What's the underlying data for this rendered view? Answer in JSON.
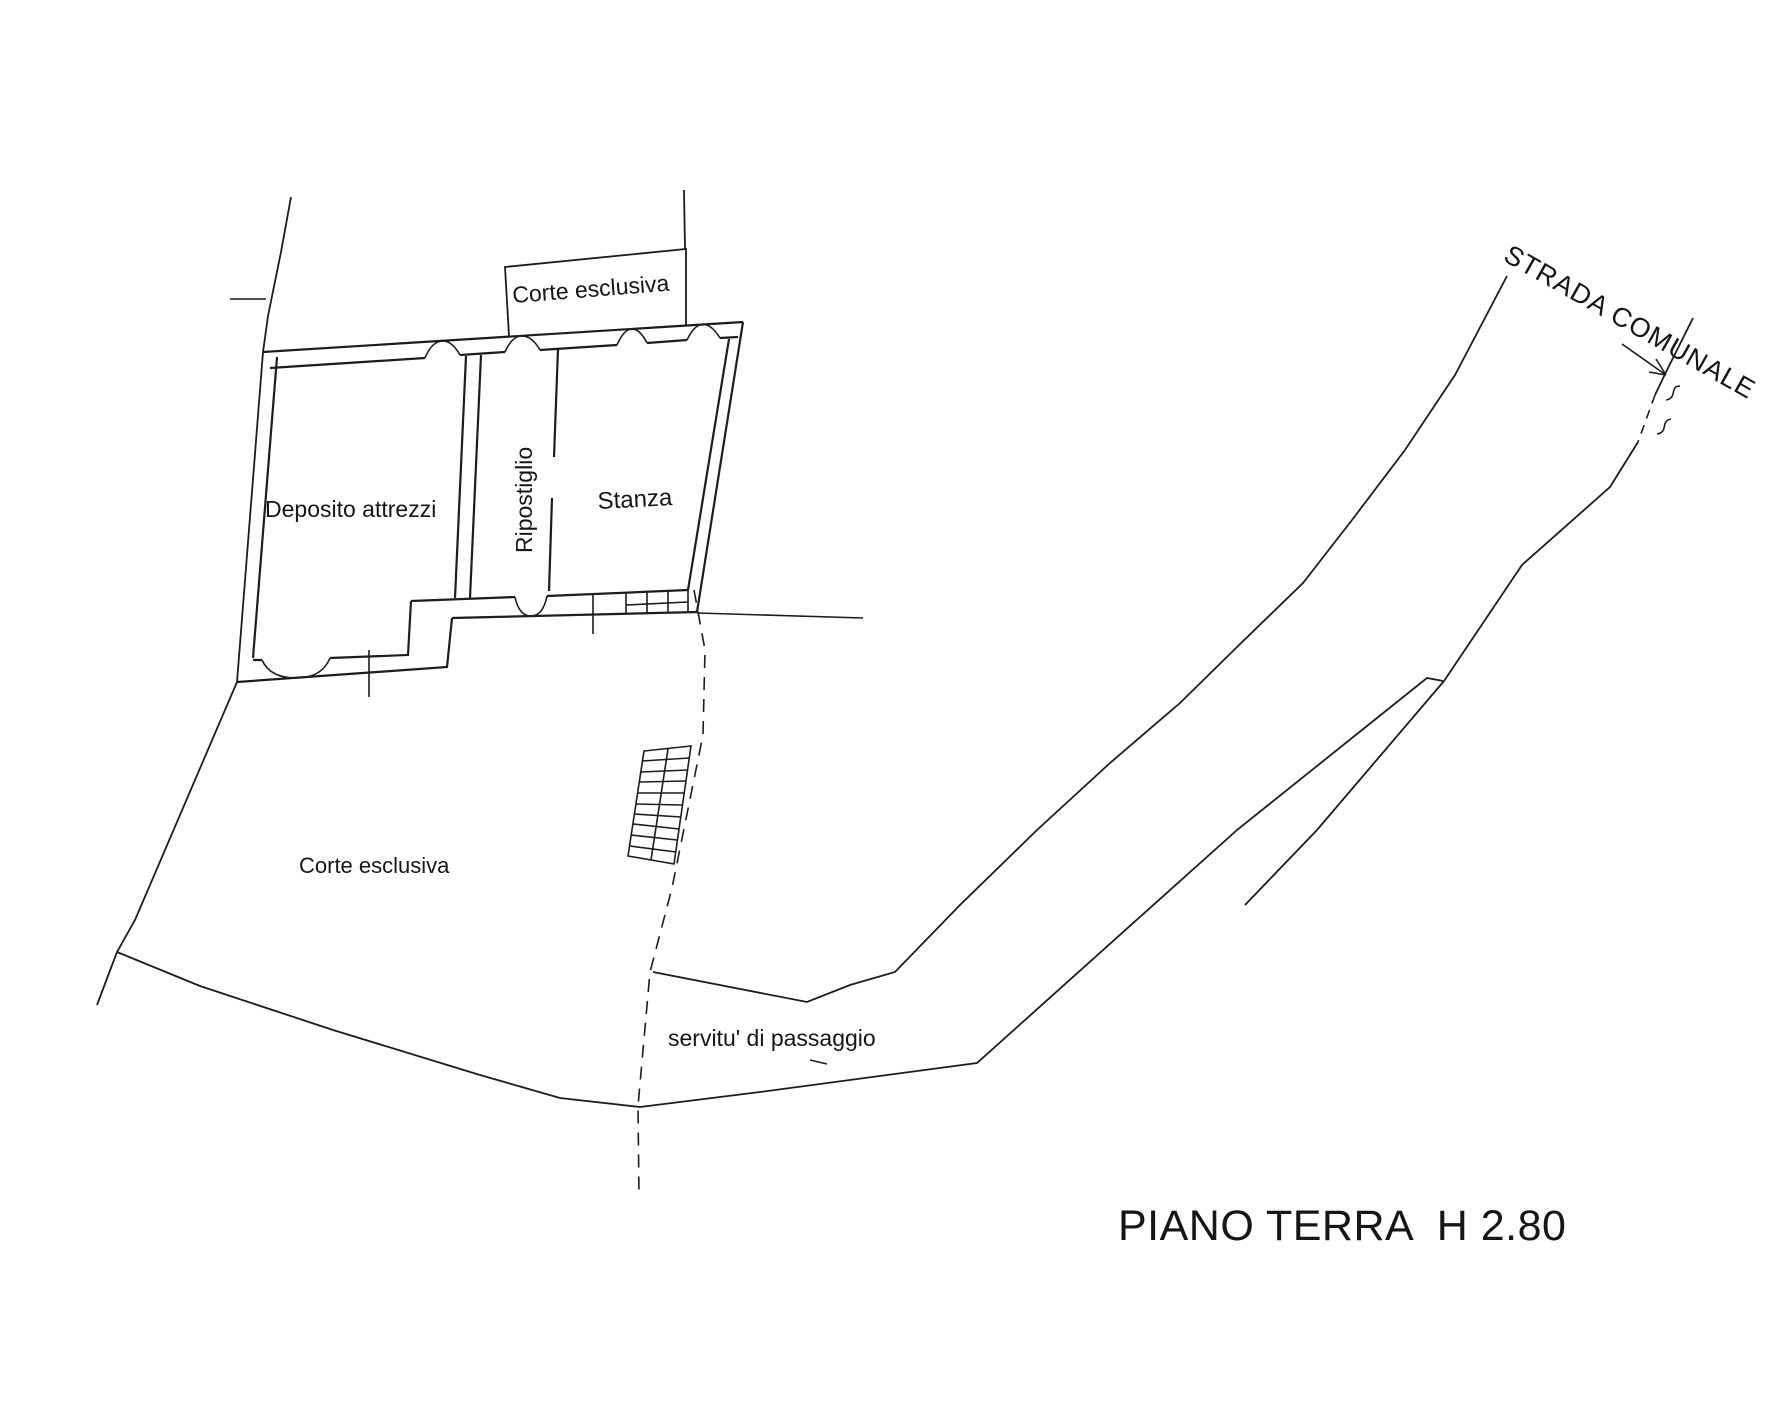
{
  "plan": {
    "floor_label": "PIANO TERRA  H 2.80",
    "areas": {
      "courtyard_top": "Corte esclusiva",
      "tool_storage": "Deposito attrezzi",
      "closet": "Ripostiglio",
      "room": "Stanza",
      "courtyard_main": "Corte esclusiva",
      "easement": "servitu' di passaggio",
      "road": "STRADA COMUNALE"
    }
  },
  "colors": {
    "ink": "#1c1c1c",
    "paper": "#ffffff"
  }
}
